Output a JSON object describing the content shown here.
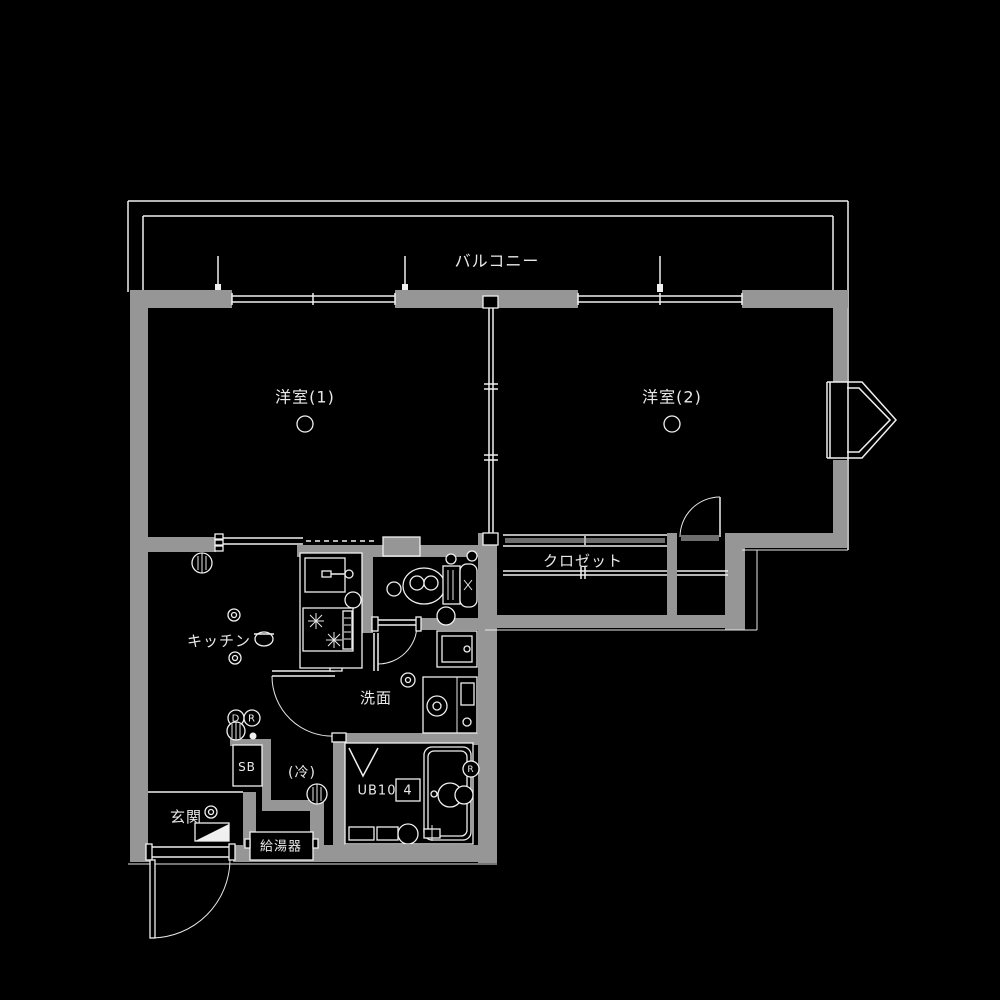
{
  "meta": {
    "type": "apartment-floor-plan",
    "style": "black-background-gray-walls"
  },
  "colors": {
    "background": "#000000",
    "wall": "#969696",
    "line": "#f0f0f0",
    "door_slab": "#6e6e6e",
    "text": "#e9e9e9"
  },
  "rooms": {
    "balcony": "バルコニー",
    "western_room_1": "洋室(1)",
    "western_room_2": "洋室(2)",
    "closet": "クロゼット",
    "kitchen": "キッチン",
    "washroom": "洗面",
    "entrance": "玄関",
    "refrigerator_space": "(冷)",
    "shoe_box": "SB",
    "unit_bath": "UB10",
    "unit_bath_size": "4",
    "water_heater": "給湯器"
  },
  "symbols": {
    "meter_d": "D",
    "meter_r": "R",
    "bath_r": "R"
  }
}
